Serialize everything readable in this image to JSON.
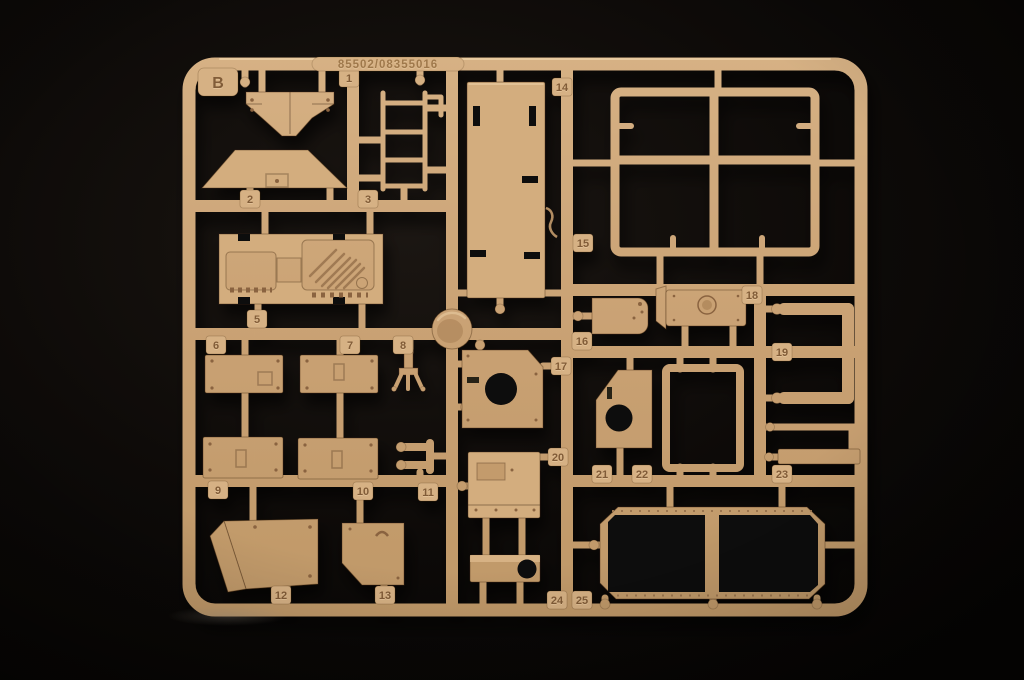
{
  "scene": {
    "subject": "Photograph of a sand-tan injection-molded plastic model kit sprue (parts tree B) on a black background",
    "background_color": "#0d0a08",
    "plastic_color": "#c9a173",
    "plastic_highlight": "#d6b184",
    "plastic_shadow": "#8a6340",
    "hole_color": "#0b0908"
  },
  "sprue": {
    "letter_tab": "B",
    "mold_number": "85502/08355016",
    "part_tabs": [
      "1",
      "2",
      "3",
      "5",
      "6",
      "7",
      "8",
      "9",
      "10",
      "11",
      "12",
      "13",
      "14",
      "15",
      "16",
      "17",
      "18",
      "19",
      "20",
      "21",
      "22",
      "23",
      "24",
      "25"
    ]
  }
}
